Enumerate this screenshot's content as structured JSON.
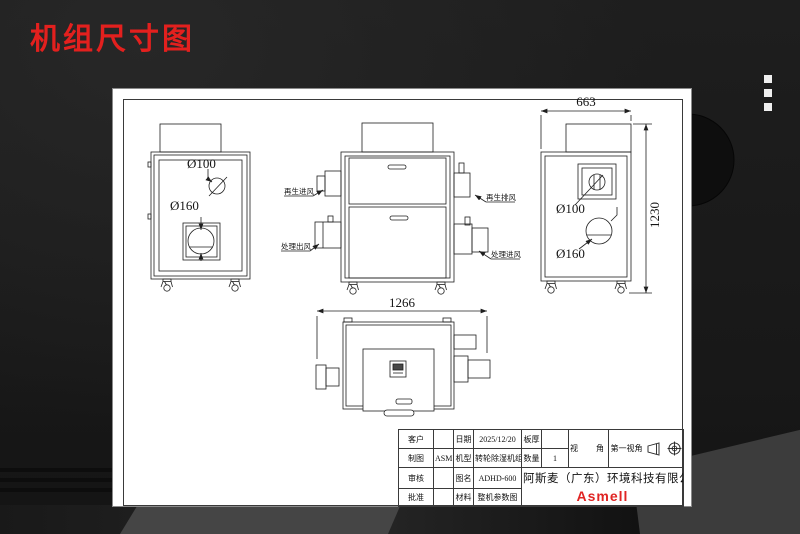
{
  "header": {
    "title": "机组尺寸图",
    "menu_icon": "vertical-dots-icon"
  },
  "drawing": {
    "left_view": {
      "dia_small": "Ø100",
      "dia_large": "Ø160"
    },
    "front_view": {
      "regen_inlet": "再生进风",
      "process_outlet": "处理出风",
      "regen_exhaust": "再生排风",
      "process_inlet": "处理进风"
    },
    "side_view": {
      "dim_width": "663",
      "dim_height": "1230",
      "dia_small": "Ø100",
      "dia_large": "Ø160"
    },
    "top_view": {
      "dim_depth": "1266"
    }
  },
  "title_block": {
    "customer_label": "客户",
    "customer_value": "",
    "date_label": "日期",
    "date_value": "2025/12/20",
    "plate_label": "板厚",
    "plate_value": "",
    "view_angle_label": "视  角",
    "view_angle_value": "第一视角",
    "drawn_label": "制图",
    "drawn_value": "ASM",
    "model_label": "机型",
    "model_value": "转轮除湿机组",
    "qty_label": "数量",
    "qty_value": "1",
    "check_label": "审核",
    "check_value": "",
    "figname_label": "图名",
    "figname_value": "ADHD-600",
    "approve_label": "批准",
    "approve_value": "",
    "material_label": "材料",
    "material_value": "整机参数图",
    "company": "阿斯麦（广东）环境科技有限公司",
    "logo": "Asmell",
    "icons": {
      "projection_cone": "cone-side-icon",
      "projection_target": "crosshair-circle-icon"
    }
  }
}
